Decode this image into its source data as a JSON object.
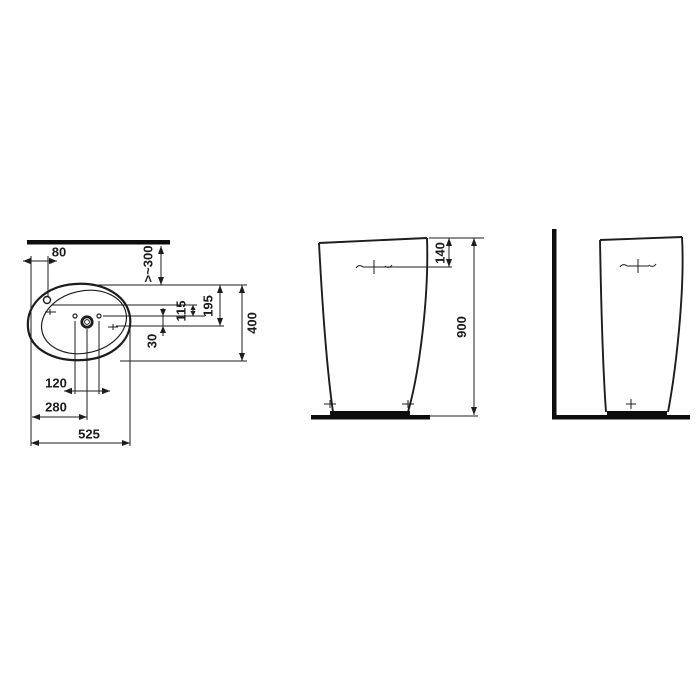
{
  "drawing": {
    "type": "technical-dimension-drawing",
    "subject": "pedestal-washbasin",
    "colors": {
      "line": "#1d1d1d",
      "thick_line": "#0d0d0d",
      "background": "#ffffff"
    },
    "plan_view": {
      "dims": {
        "tap_offset": "80",
        "wall_clearance": ">~300",
        "back_to_drain": "195",
        "tap_to_drain": "115",
        "holes_to_drain": "30",
        "overall_depth": "400",
        "holes_spacing": "120",
        "edge_to_drain": "280",
        "overall_width": "525"
      }
    },
    "front_view": {
      "dims": {
        "tap_from_top": "140",
        "overall_height": "900"
      }
    },
    "side_view": {
      "dims": {}
    }
  }
}
